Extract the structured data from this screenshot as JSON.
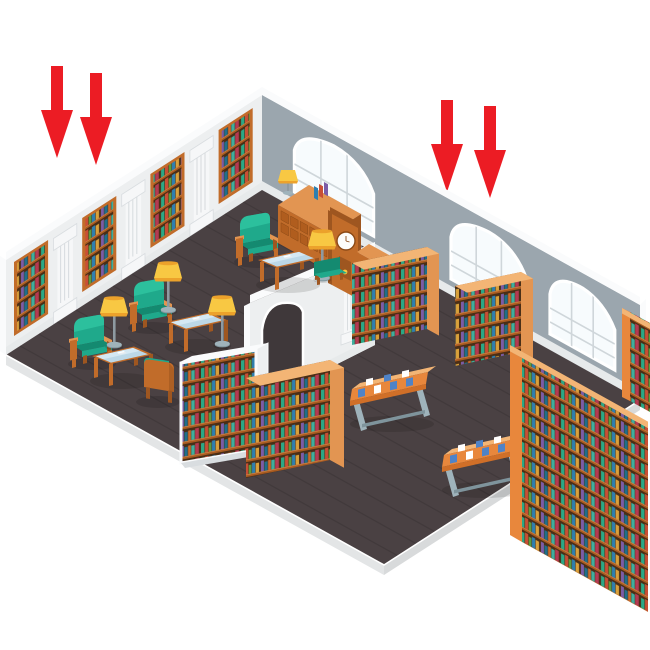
{
  "image": {
    "kind": "isometric illustration",
    "subject": "library interior cutaway with two zones",
    "background": "#ffffff"
  },
  "annotations": {
    "arrow_color": "#ec1c24",
    "arrow_direction": "down",
    "groups": [
      {
        "id": "left-pair",
        "count": 2,
        "points_at": "reading room"
      },
      {
        "id": "right-pair",
        "count": 2,
        "points_at": "book stacks room"
      }
    ]
  },
  "scene": {
    "left_room": {
      "wall_bookshelf_panels": 4,
      "wall_columns": 3,
      "armchairs_front_facing": 3,
      "armchairs_back_facing": 1,
      "floor_lamps": 4,
      "coffee_tables": 3,
      "other_furniture": [
        "card-catalog-cabinet",
        "table-lamp",
        "grandfather-clock",
        "drawer-chest",
        "green-bench",
        "white-bookcase"
      ]
    },
    "right_room": {
      "freestanding_bookshelves": 5,
      "display_tables": 2,
      "arched_windows": 2
    },
    "architecture": {
      "arched_windows_total": 3,
      "divider": "white wall with archway and column",
      "floor": "dark wood planks"
    }
  },
  "colors": {
    "white": "#ffffff",
    "arrow": "#ec1c24",
    "floor": "#4a4143",
    "plank": "#3f383a",
    "floorEdge": "#d8dadb",
    "wall": "#edeff0",
    "wallWhite": "#fafbfc",
    "wallBase": "#e7eaeb",
    "wallGray": "#9ba6ae",
    "window": "#f7fbfd",
    "mullion": "#cfd6da",
    "column": "#f6f7f8",
    "columnShade": "#d9dde0",
    "wood": "#c16c2a",
    "woodDark": "#9e5620",
    "woodLight": "#e29552",
    "woodTop": "#f3b575",
    "shelfBg": "#4a2e16",
    "shelfBoard": "#a85a20",
    "shelfBoardHi": "#d98c4a",
    "green": "#1fa98b",
    "greenDark": "#148a70",
    "greenLight": "#2fc4a0",
    "yellow": "#f8c843",
    "yellowDark": "#eca22b",
    "pole": "#8e9aa1",
    "glass": "#bcd8e7",
    "glassHi": "#daecf6",
    "gray": "#9fb3bb",
    "grayDark": "#7f949c",
    "orange": "#e8873c",
    "orangeDark": "#d06f28",
    "bookBlue": "#4f83c7",
    "b0": "#2ba886",
    "b1": "#c94f35",
    "b2": "#5a9e3e",
    "b3": "#2e7fb0",
    "b4": "#d9a13b",
    "b5": "#7b5ca6",
    "b6": "#1f6f8b",
    "b7": "#cc6b2c",
    "b8": "#3fae9e",
    "b9": "#b43a52"
  }
}
